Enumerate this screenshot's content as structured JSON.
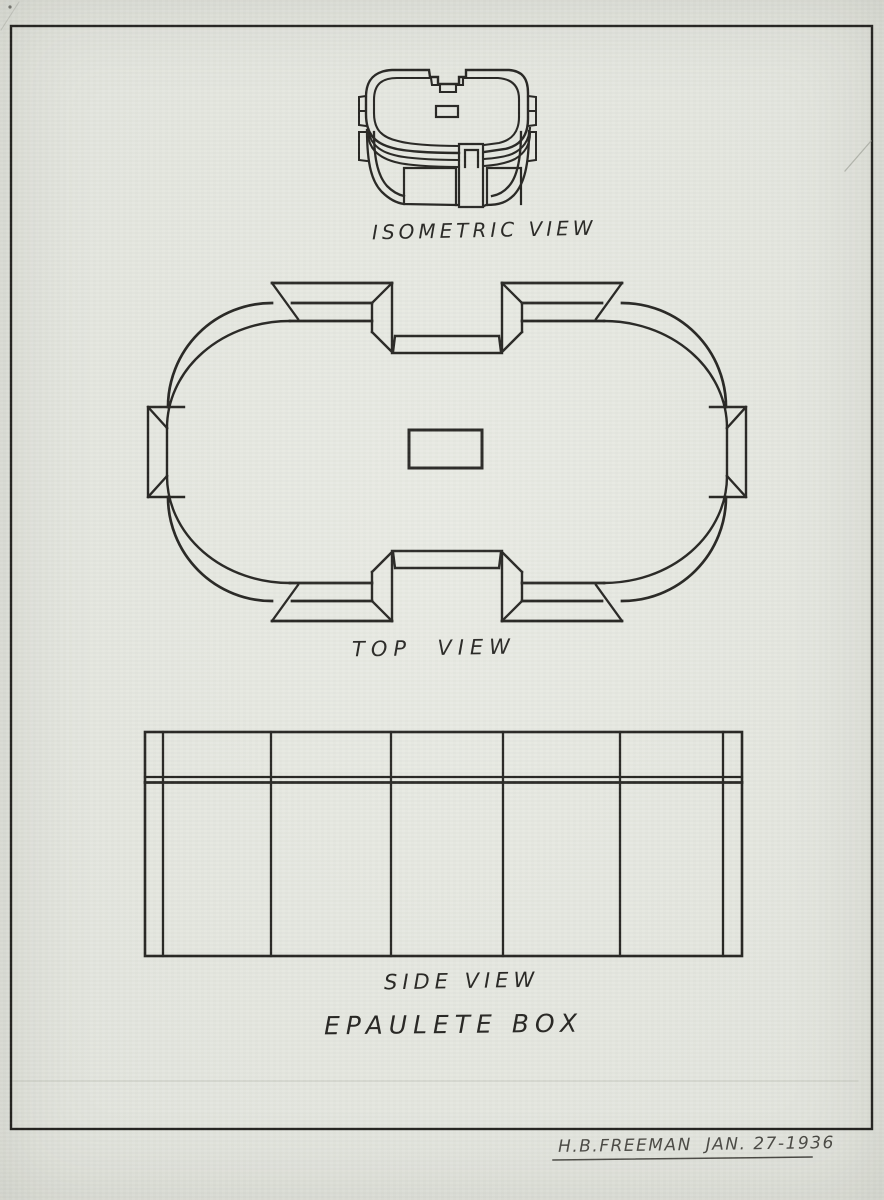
{
  "document": {
    "type": "hand-drawn technical drawing, three views of a box",
    "title": "EPAULETE BOX",
    "labels": {
      "isometric": "ISOMETRIC VIEW",
      "top": "TOP  VIEW",
      "side": "SIDE VIEW"
    },
    "signature": "H.B.FREEMAN  JAN. 27-1936",
    "colors": {
      "paper": "#e8eae3",
      "ink": "#1d1c19",
      "pencil": "#9b9d95"
    }
  }
}
